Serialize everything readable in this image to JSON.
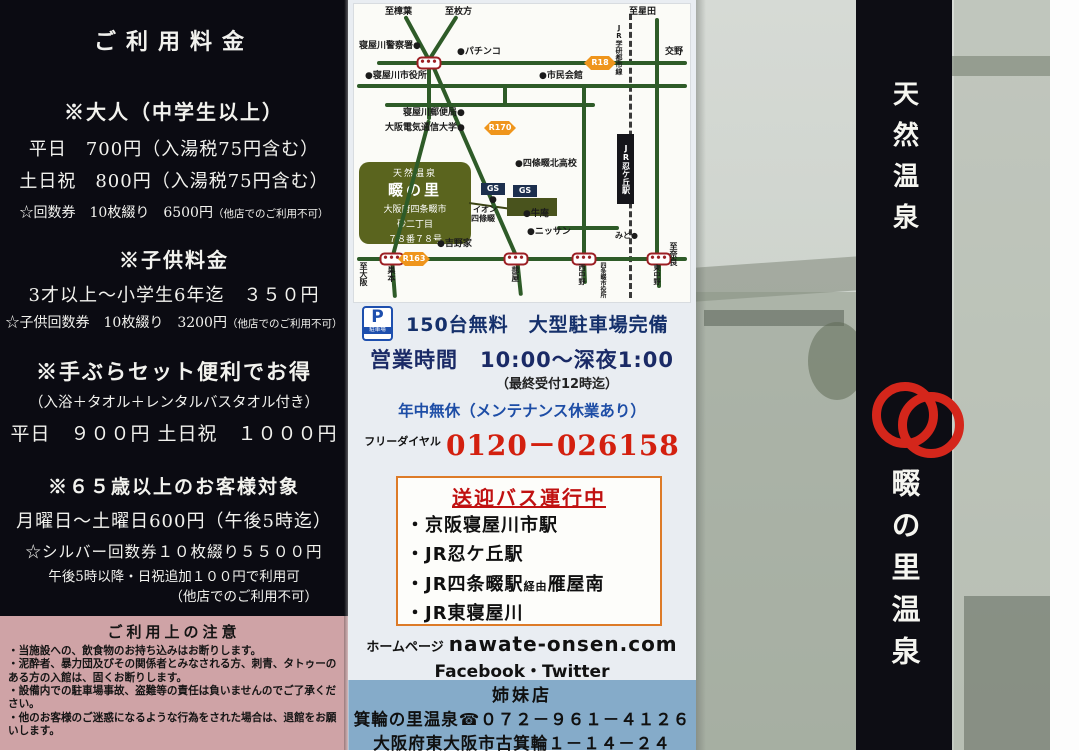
{
  "left": {
    "title": "ご利用料金",
    "adult": {
      "heading": "※大人（中学生以上）",
      "line1": "平日　700円（入湯税75円含む）",
      "line2": "土日祝　800円（入湯税75円含む）",
      "note": "☆回数券　10枚綴り　6500円",
      "note_small": "（他店でのご利用不可）"
    },
    "child": {
      "heading": "※子供料金",
      "line1": "3才以上～小学生6年迄　３５０円",
      "note": "☆子供回数券　10枚綴り　3200円",
      "note_small": "（他店でのご利用不可）"
    },
    "tebura": {
      "heading": "※手ぶらセット便利でお得",
      "line1": "（入浴＋タオル＋レンタルバスタオル付き）",
      "line2": "平日　９００円 土日祝　１０００円"
    },
    "senior": {
      "heading": "※６５歳以上のお客様対象",
      "line1": "月曜日～土曜日600円（午後5時迄）",
      "line2": "☆シルバー回数券１０枚綴り５５００円",
      "line3": "午後5時以降・日祝追加１００円で利用可",
      "line4": "（他店でのご利用不可）"
    },
    "notes": [
      "□浴室洗い場にはシャンプー　リンス　ボディソープをご用意しております",
      "タオル　バスタオルは各自ご持参ください（販売もしております）。",
      "□券売機にて入浴券をお買い求めの上、フロントへお持ちください。"
    ],
    "caution": {
      "title": "ご利用上の注意",
      "items": [
        "・当施設への、飲食物のお持ち込みはお断りします。",
        "・泥酔者、暴力団及びその関係者とみなされる方、刺青、タトゥーのある方の入館は、固くお断りします。",
        "・設備内での駐車場事故、盗難等の責任は負いませんのでご了承ください。",
        "・他のお客様のご迷惑になるような行為をされた場合は、退館をお願いします。"
      ]
    }
  },
  "map": {
    "callout": {
      "lines": [
        "天然温泉",
        "畷の里",
        "大阪府四条畷市",
        "砂二丁目",
        "７８番７８号"
      ]
    },
    "roads": [
      {
        "x1": 72,
        "y1": 54,
        "x2": 48,
        "y2": 10
      },
      {
        "x1": 72,
        "y1": 54,
        "x2": 100,
        "y2": 10
      },
      {
        "x1": 72,
        "y1": 54,
        "x2": 72,
        "y2": 114
      },
      {
        "x1": 72,
        "y1": 114,
        "x2": 35,
        "y2": 253
      },
      {
        "x1": 35,
        "y1": 253,
        "x2": 38,
        "y2": 292
      },
      {
        "x1": 20,
        "y1": 57,
        "x2": 330,
        "y2": 57
      },
      {
        "x1": 0,
        "y1": 80,
        "x2": 330,
        "y2": 80
      },
      {
        "x1": 28,
        "y1": 99,
        "x2": 238,
        "y2": 99
      },
      {
        "x1": 76,
        "y1": 60,
        "x2": 160,
        "y2": 252
      },
      {
        "x1": 160,
        "y1": 252,
        "x2": 164,
        "y2": 290
      },
      {
        "x1": 227,
        "y1": 80,
        "x2": 227,
        "y2": 253
      },
      {
        "x1": 227,
        "y1": 253,
        "x2": 228,
        "y2": 278
      },
      {
        "x1": 300,
        "y1": 12,
        "x2": 300,
        "y2": 253
      },
      {
        "x1": 302,
        "y1": 253,
        "x2": 302,
        "y2": 282
      },
      {
        "x1": 0,
        "y1": 253,
        "x2": 330,
        "y2": 253
      },
      {
        "x1": 200,
        "y1": 222,
        "x2": 262,
        "y2": 222
      },
      {
        "x1": 148,
        "y1": 80,
        "x2": 148,
        "y2": 99
      }
    ],
    "signals": [
      {
        "x": 72,
        "y": 57
      },
      {
        "x": 35,
        "y": 253
      },
      {
        "x": 159,
        "y": 253
      },
      {
        "x": 227,
        "y": 253
      },
      {
        "x": 302,
        "y": 253
      }
    ],
    "badges": [
      {
        "x": 243,
        "y": 57,
        "t": "R18"
      },
      {
        "x": 143,
        "y": 122,
        "t": "R170"
      },
      {
        "x": 57,
        "y": 253,
        "t": "R163"
      }
    ],
    "blocks": [
      {
        "x": 260,
        "y": 128,
        "w": 17,
        "h": 70,
        "bg": "#15151a",
        "c": "#ffffff",
        "t": "JR忍ケ丘駅",
        "v": true,
        "fs": 8
      },
      {
        "x": 124,
        "y": 177,
        "w": 24,
        "h": 12,
        "bg": "#1c2f4e",
        "c": "#ffffff",
        "t": "GS",
        "fs": 8
      },
      {
        "x": 156,
        "y": 179,
        "w": 24,
        "h": 12,
        "bg": "#1c2f4e",
        "c": "#ffffff",
        "t": "GS",
        "fs": 8
      },
      {
        "x": 150,
        "y": 192,
        "w": 50,
        "h": 18,
        "bg": "#49531d",
        "c": "#49531d",
        "t": "",
        "fs": 8
      }
    ],
    "labels": [
      {
        "t": "至樟葉",
        "x": 28,
        "y": 2
      },
      {
        "t": "至枚方",
        "x": 88,
        "y": 2
      },
      {
        "t": "至星田",
        "x": 272,
        "y": 2
      },
      {
        "t": "寝屋川警察署●",
        "x": 2,
        "y": 36
      },
      {
        "t": "●パチンコ",
        "x": 100,
        "y": 42
      },
      {
        "t": "交野",
        "x": 308,
        "y": 42
      },
      {
        "t": "●寝屋川市役所",
        "x": 8,
        "y": 66
      },
      {
        "t": "●市民会館",
        "x": 182,
        "y": 66
      },
      {
        "t": "寝屋川郵便局●",
        "x": 46,
        "y": 103
      },
      {
        "t": "大阪電気通信大学●",
        "x": 28,
        "y": 118
      },
      {
        "t": "●四條畷北高校",
        "x": 158,
        "y": 154
      },
      {
        "t": "●",
        "x": 132,
        "y": 190
      },
      {
        "t": "イオン",
        "x": 116,
        "y": 200,
        "fs": 8
      },
      {
        "t": "四條畷",
        "x": 114,
        "y": 209,
        "fs": 8
      },
      {
        "t": "●牛庵",
        "x": 166,
        "y": 204
      },
      {
        "t": "●ニッサン",
        "x": 170,
        "y": 222
      },
      {
        "t": "●吉野家",
        "x": 80,
        "y": 234
      },
      {
        "t": "みど●",
        "x": 258,
        "y": 226,
        "fs": 8
      },
      {
        "t": "JR学研都市線",
        "x": 258,
        "y": 18,
        "v": true,
        "fs": 7
      },
      {
        "t": "至大阪",
        "x": 2,
        "y": 256,
        "v": true,
        "fs": 8
      },
      {
        "t": "巣本",
        "x": 30,
        "y": 260,
        "v": true,
        "fs": 8
      },
      {
        "t": "蔀屋",
        "x": 154,
        "y": 260,
        "v": true,
        "fs": 8
      },
      {
        "t": "西中野",
        "x": 221,
        "y": 258,
        "v": true,
        "fs": 7
      },
      {
        "t": "四条畷市役所",
        "x": 242,
        "y": 256,
        "v": true,
        "fs": 6
      },
      {
        "t": "東中野",
        "x": 296,
        "y": 258,
        "v": true,
        "fs": 7
      },
      {
        "t": "至奈良",
        "x": 312,
        "y": 236,
        "v": true,
        "fs": 8
      }
    ]
  },
  "info": {
    "parking_icon_p": "P",
    "parking_icon_sub": "駐車場",
    "parking_text": "150台無料　大型駐車場完備",
    "hours_label": "営業時間",
    "hours_value": "10:00～深夜1:00",
    "hours_note": "（最終受付12時迄）",
    "holiday": "年中無休（メンテナンス休業あり）",
    "freedial_label": "フリーダイヤル",
    "freedial_number": "0120－026158"
  },
  "shuttle": {
    "title": "送迎バス運行中",
    "items": [
      "・京阪寝屋川市駅",
      "・JR忍ケ丘駅",
      "・JR四条畷駅",
      "・JR東寝屋川"
    ],
    "via": "経由",
    "via_dest": "雁屋南"
  },
  "web": {
    "label": "ホームページ",
    "url": "nawate-onsen.com",
    "social": "Facebook・Twitter"
  },
  "sister": {
    "title": "姉妹店",
    "name_phone": "箕輪の里温泉☎０７２－９６１－４１２６",
    "address": "大阪府東大阪市古箕輪１－１４－２４"
  },
  "right": {
    "top_title": "天然温泉",
    "name": "畷の里温泉"
  },
  "colors": {
    "accent_red": "#d3200f",
    "logo_red": "#d4261b",
    "badge_orange": "#ef951c",
    "pink_band": "#cfa3a6",
    "blue_band": "#85abc9"
  }
}
